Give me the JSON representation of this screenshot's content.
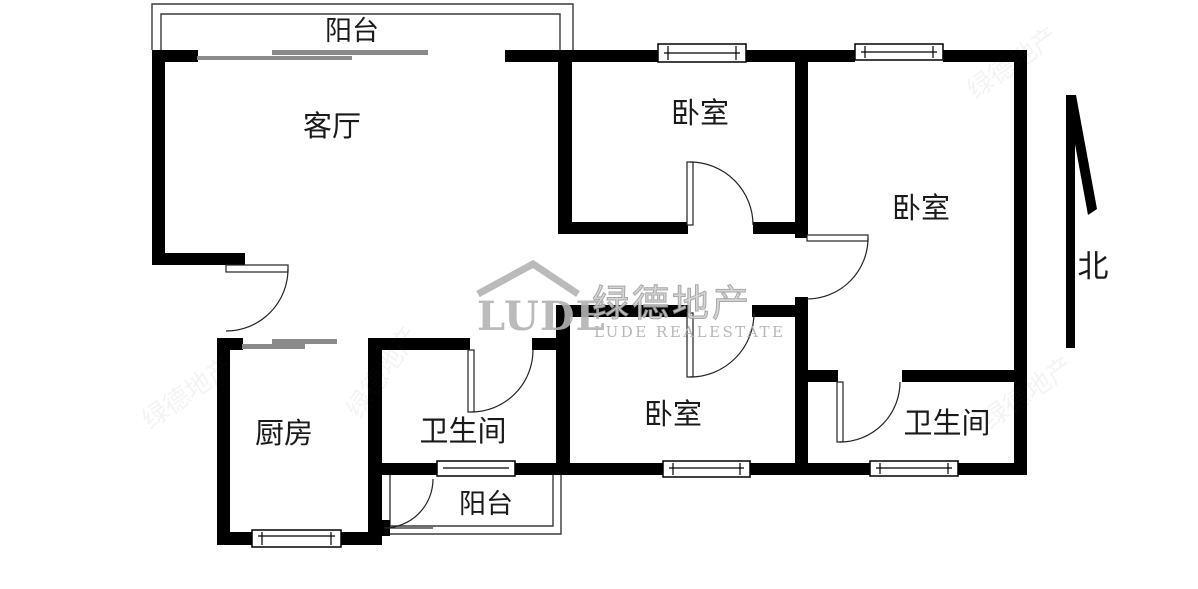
{
  "floorplan": {
    "rooms": {
      "balcony_top": "阳台",
      "living_room": "客厅",
      "bedroom_top": "卧室",
      "bedroom_right": "卧室",
      "kitchen": "厨房",
      "bathroom_left": "卫生间",
      "bedroom_bottom": "卧室",
      "bathroom_right": "卫生间",
      "balcony_bottom": "阳台"
    },
    "compass": {
      "north_label": "北"
    },
    "watermark": {
      "logo": "LUDE",
      "brand_cn": "绿德地产",
      "brand_en": "LUDE REALESTATE"
    },
    "colors": {
      "wall": "#000000",
      "thin_line": "#3a3a3a",
      "slider_gray": "#8a8a8a",
      "watermark_gray": "#b3b3b3"
    }
  }
}
